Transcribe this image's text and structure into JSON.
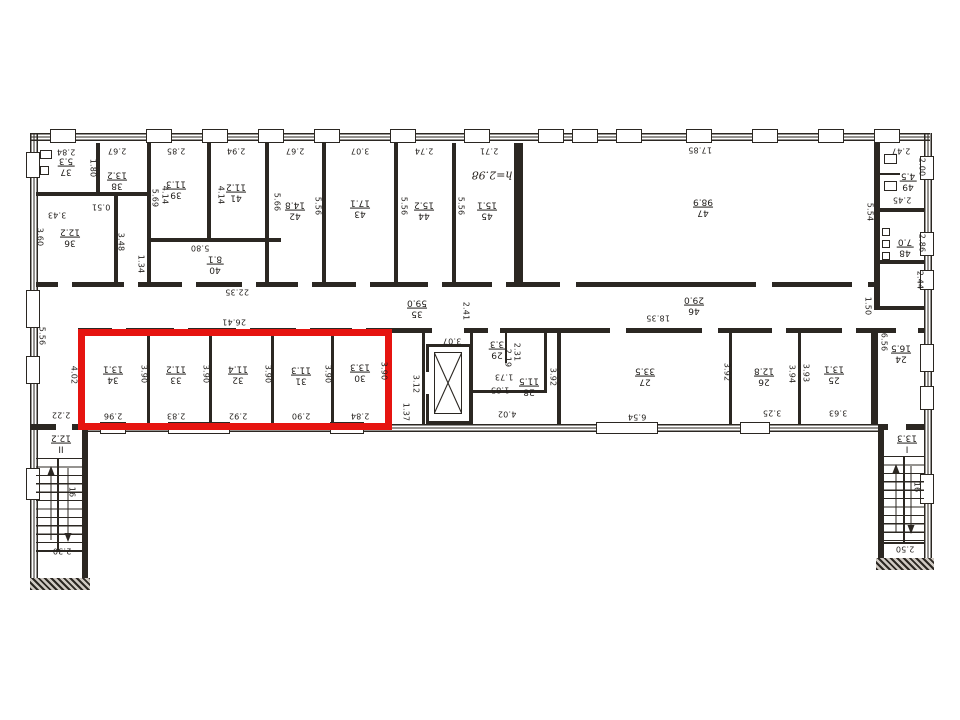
{
  "drawing": {
    "type": "building floor plan (scanned technical drawing)",
    "text_rotation_deg": 180
  },
  "highlight": {
    "color": "#e61410",
    "shape": "rectangle"
  },
  "rooms": [
    {
      "number": "37",
      "area": "5.3",
      "x": 66,
      "y": 166
    },
    {
      "number": "38",
      "area": "13.2",
      "x": 117,
      "y": 180
    },
    {
      "number": "39",
      "area": "11.3",
      "x": 176,
      "y": 189
    },
    {
      "number": "41",
      "area": "11.2",
      "x": 236,
      "y": 192
    },
    {
      "number": "40",
      "area": "8.1",
      "x": 215,
      "y": 264
    },
    {
      "number": "36",
      "area": "12.2",
      "x": 70,
      "y": 237
    },
    {
      "number": "42",
      "area": "14.8",
      "x": 295,
      "y": 210
    },
    {
      "number": "43",
      "area": "17.1",
      "x": 360,
      "y": 208
    },
    {
      "number": "44",
      "area": "15.2",
      "x": 424,
      "y": 210
    },
    {
      "number": "45",
      "area": "15.1",
      "x": 487,
      "y": 210
    },
    {
      "number": "47",
      "area": "98.9",
      "x": 703,
      "y": 207
    },
    {
      "number": "49",
      "area": "4.5",
      "x": 908,
      "y": 181
    },
    {
      "number": "48",
      "area": "7.0",
      "x": 905,
      "y": 247
    },
    {
      "number": "35",
      "area": "59.0",
      "x": 417,
      "y": 308
    },
    {
      "number": "46",
      "area": "29.0",
      "x": 694,
      "y": 305
    },
    {
      "number": "34",
      "area": "13.1",
      "x": 113,
      "y": 374
    },
    {
      "number": "33",
      "area": "11.2",
      "x": 176,
      "y": 374
    },
    {
      "number": "32",
      "area": "11.4",
      "x": 238,
      "y": 374
    },
    {
      "number": "31",
      "area": "11.3",
      "x": 301,
      "y": 375
    },
    {
      "number": "30",
      "area": "13.3",
      "x": 360,
      "y": 372
    },
    {
      "number": "29",
      "area": "3.3",
      "x": 497,
      "y": 349
    },
    {
      "number": "28",
      "area": "11.5",
      "x": 529,
      "y": 386
    },
    {
      "number": "27",
      "area": "33.5",
      "x": 645,
      "y": 376
    },
    {
      "number": "26",
      "area": "12.8",
      "x": 764,
      "y": 376
    },
    {
      "number": "25",
      "area": "13.1",
      "x": 834,
      "y": 374
    },
    {
      "number": "24",
      "area": "16.5",
      "x": 901,
      "y": 353
    },
    {
      "number": "I",
      "area": "13.3",
      "x": 907,
      "y": 443
    },
    {
      "number": "II",
      "area": "12.2",
      "x": 61,
      "y": 443
    }
  ],
  "dimensions": [
    {
      "value": "2.84",
      "x": 66,
      "y": 152,
      "o": "h"
    },
    {
      "value": "2.67",
      "x": 117,
      "y": 151,
      "o": "h"
    },
    {
      "value": "2.85",
      "x": 176,
      "y": 151,
      "o": "h"
    },
    {
      "value": "2.94",
      "x": 236,
      "y": 151,
      "o": "h"
    },
    {
      "value": "2.67",
      "x": 295,
      "y": 151,
      "o": "h"
    },
    {
      "value": "3.07",
      "x": 360,
      "y": 151,
      "o": "h"
    },
    {
      "value": "2.74",
      "x": 424,
      "y": 151,
      "o": "h"
    },
    {
      "value": "2.71",
      "x": 489,
      "y": 151,
      "o": "h"
    },
    {
      "value": "17.85",
      "x": 700,
      "y": 150,
      "o": "h"
    },
    {
      "value": "2.47",
      "x": 901,
      "y": 151,
      "o": "h"
    },
    {
      "value": "1.80",
      "x": 93,
      "y": 168,
      "o": "v"
    },
    {
      "value": "5.69",
      "x": 155,
      "y": 198,
      "o": "v"
    },
    {
      "value": "4.14",
      "x": 165,
      "y": 195,
      "o": "v"
    },
    {
      "value": "4.14",
      "x": 221,
      "y": 195,
      "o": "v"
    },
    {
      "value": "5.66",
      "x": 277,
      "y": 202,
      "o": "v"
    },
    {
      "value": "5.56",
      "x": 318,
      "y": 206,
      "o": "v"
    },
    {
      "value": "5.56",
      "x": 404,
      "y": 206,
      "o": "v"
    },
    {
      "value": "5.56",
      "x": 461,
      "y": 206,
      "o": "v"
    },
    {
      "value": "5.54",
      "x": 870,
      "y": 212,
      "o": "v"
    },
    {
      "value": "2.00",
      "x": 922,
      "y": 167,
      "o": "v"
    },
    {
      "value": "2.45",
      "x": 902,
      "y": 200,
      "o": "h"
    },
    {
      "value": "2.86",
      "x": 922,
      "y": 243,
      "o": "v"
    },
    {
      "value": "2.44",
      "x": 920,
      "y": 280,
      "o": "v"
    },
    {
      "value": "1.50",
      "x": 868,
      "y": 306,
      "o": "v"
    },
    {
      "value": "3.60",
      "x": 40,
      "y": 237,
      "o": "v"
    },
    {
      "value": "3.43",
      "x": 57,
      "y": 215,
      "o": "h"
    },
    {
      "value": "0.51",
      "x": 101,
      "y": 207,
      "o": "h"
    },
    {
      "value": "3.48",
      "x": 121,
      "y": 242,
      "o": "v"
    },
    {
      "value": "1.34",
      "x": 141,
      "y": 264,
      "o": "v"
    },
    {
      "value": "5.80",
      "x": 200,
      "y": 248,
      "o": "h"
    },
    {
      "value": "22.35",
      "x": 237,
      "y": 292,
      "o": "h"
    },
    {
      "value": "26.41",
      "x": 234,
      "y": 322,
      "o": "h"
    },
    {
      "value": "2.41",
      "x": 466,
      "y": 311,
      "o": "v"
    },
    {
      "value": "3.07",
      "x": 452,
      "y": 341,
      "o": "h"
    },
    {
      "value": "18.35",
      "x": 658,
      "y": 318,
      "o": "h"
    },
    {
      "value": "5.56",
      "x": 42,
      "y": 336,
      "o": "v"
    },
    {
      "value": "4.02",
      "x": 74,
      "y": 375,
      "o": "v"
    },
    {
      "value": "3.90",
      "x": 144,
      "y": 374,
      "o": "v"
    },
    {
      "value": "3.90",
      "x": 206,
      "y": 374,
      "o": "v"
    },
    {
      "value": "3.90",
      "x": 268,
      "y": 374,
      "o": "v"
    },
    {
      "value": "3.90",
      "x": 328,
      "y": 374,
      "o": "v"
    },
    {
      "value": "3.90",
      "x": 384,
      "y": 371,
      "o": "v"
    },
    {
      "value": "2.96",
      "x": 113,
      "y": 416,
      "o": "h"
    },
    {
      "value": "2.83",
      "x": 176,
      "y": 416,
      "o": "h"
    },
    {
      "value": "2.92",
      "x": 238,
      "y": 416,
      "o": "h"
    },
    {
      "value": "2.90",
      "x": 301,
      "y": 416,
      "o": "h"
    },
    {
      "value": "2.84",
      "x": 360,
      "y": 416,
      "o": "h"
    },
    {
      "value": "1.37",
      "x": 406,
      "y": 412,
      "o": "v"
    },
    {
      "value": "3.12",
      "x": 416,
      "y": 384,
      "o": "v"
    },
    {
      "value": "2.19",
      "x": 508,
      "y": 358,
      "o": "v"
    },
    {
      "value": "2.31",
      "x": 517,
      "y": 352,
      "o": "v"
    },
    {
      "value": "1.73",
      "x": 504,
      "y": 377,
      "o": "h"
    },
    {
      "value": "1.85",
      "x": 500,
      "y": 390,
      "o": "h"
    },
    {
      "value": "4.02",
      "x": 507,
      "y": 414,
      "o": "h"
    },
    {
      "value": "3.92",
      "x": 553,
      "y": 377,
      "o": "v"
    },
    {
      "value": "6.54",
      "x": 637,
      "y": 417,
      "o": "h"
    },
    {
      "value": "3.92",
      "x": 727,
      "y": 372,
      "o": "v"
    },
    {
      "value": "3.25",
      "x": 772,
      "y": 413,
      "o": "h"
    },
    {
      "value": "3.94",
      "x": 792,
      "y": 374,
      "o": "v"
    },
    {
      "value": "3.63",
      "x": 838,
      "y": 413,
      "o": "h"
    },
    {
      "value": "3.93",
      "x": 806,
      "y": 373,
      "o": "v"
    },
    {
      "value": "6.56",
      "x": 884,
      "y": 342,
      "o": "v"
    },
    {
      "value": "2.22",
      "x": 61,
      "y": 415,
      "o": "h"
    },
    {
      "value": "2.30",
      "x": 62,
      "y": 551,
      "o": "h"
    },
    {
      "value": "2.50",
      "x": 905,
      "y": 549,
      "o": "h"
    },
    {
      "value": "16",
      "x": 72,
      "y": 492,
      "o": "v"
    },
    {
      "value": "16",
      "x": 917,
      "y": 487,
      "o": "v"
    }
  ],
  "annotations": [
    {
      "text": "h=2.98",
      "x": 492,
      "y": 175,
      "style": "handwritten"
    }
  ]
}
